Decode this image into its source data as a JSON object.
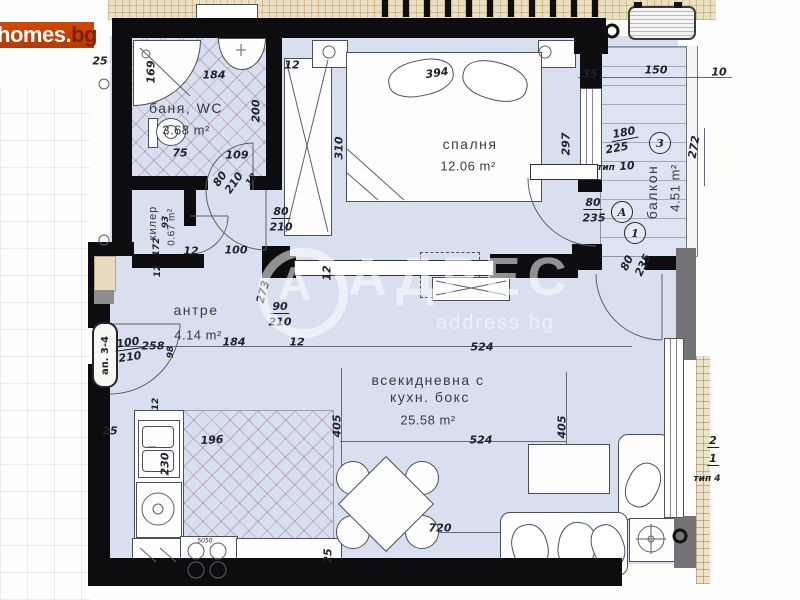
{
  "logo": {
    "homes": "homes",
    "dot": ".",
    "bg": "bg"
  },
  "watermark": {
    "brand": "АДРЕС",
    "domain": "address.bg",
    "monogram": "А"
  },
  "entrance_label": "ап. 3-4",
  "rooms_summary": [
    {
      "name": "баня, WC",
      "area_m2": "3.68 m²"
    },
    {
      "name": "килер",
      "area_m2": "0.67 m²"
    },
    {
      "name": "спалня",
      "area_m2": "12.06 m²"
    },
    {
      "name": "антре",
      "area_m2": "4.14 m²"
    },
    {
      "name": "всекидневна с кухн. бокс",
      "area_m2": "25.58 m²"
    },
    {
      "name": "балкон",
      "area_m2": "4.51 m²"
    }
  ],
  "room_labels": [
    {
      "t": "баня, WC",
      "x": 186,
      "y": 108,
      "r": 0,
      "c": "room"
    },
    {
      "t": "3.68 m²",
      "x": 186,
      "y": 130,
      "r": 0,
      "c": "area"
    },
    {
      "t": "килер",
      "x": 153,
      "y": 223,
      "r": -90,
      "c": "room sm"
    },
    {
      "t": "0.67 m²",
      "x": 172,
      "y": 227,
      "r": -90,
      "c": "area sm"
    },
    {
      "t": "спалня",
      "x": 470,
      "y": 144,
      "r": 0,
      "c": "room"
    },
    {
      "t": "12.06 m²",
      "x": 468,
      "y": 166,
      "r": 0,
      "c": "area"
    },
    {
      "t": "антре",
      "x": 196,
      "y": 310,
      "r": 0,
      "c": "room"
    },
    {
      "t": "4.14 m²",
      "x": 198,
      "y": 335,
      "r": 0,
      "c": "area"
    },
    {
      "t": "всекидневна с",
      "x": 428,
      "y": 380,
      "r": 0,
      "c": "room"
    },
    {
      "t": "кухн. бокс",
      "x": 430,
      "y": 397,
      "r": 0,
      "c": "room"
    },
    {
      "t": "25.58 m²",
      "x": 428,
      "y": 420,
      "r": 0,
      "c": "area"
    },
    {
      "t": "балкон",
      "x": 652,
      "y": 192,
      "r": -90,
      "c": "room"
    },
    {
      "t": "4.51 m²",
      "x": 675,
      "y": 188,
      "r": -90,
      "c": "area"
    }
  ],
  "dimensions": [
    {
      "t": "25",
      "x": 100,
      "y": 61,
      "r": 0
    },
    {
      "t": "169",
      "x": 151,
      "y": 72,
      "r": -90
    },
    {
      "t": "184",
      "x": 214,
      "y": 75,
      "r": 0
    },
    {
      "t": "12",
      "x": 292,
      "y": 65,
      "r": 0
    },
    {
      "t": "394",
      "x": 437,
      "y": 73,
      "r": -8
    },
    {
      "t": "35",
      "x": 590,
      "y": 74,
      "r": 0
    },
    {
      "t": "150",
      "x": 656,
      "y": 70,
      "r": 0
    },
    {
      "t": "10",
      "x": 719,
      "y": 72,
      "r": 0
    },
    {
      "t": "200",
      "x": 256,
      "y": 111,
      "r": -90
    },
    {
      "t": "75",
      "x": 180,
      "y": 153,
      "r": 0
    },
    {
      "t": "109",
      "x": 237,
      "y": 155,
      "r": 0
    },
    {
      "t": "80",
      "x": 220,
      "y": 179,
      "r": -55
    },
    {
      "t": "210",
      "x": 234,
      "y": 183,
      "r": -55
    },
    {
      "t": "12",
      "x": 252,
      "y": 180,
      "r": -55,
      "c": "tiny"
    },
    {
      "t": "93",
      "x": 166,
      "y": 222,
      "r": -90,
      "c": "tiny"
    },
    {
      "t": "172",
      "x": 157,
      "y": 247,
      "r": -90,
      "c": "tiny"
    },
    {
      "t": "12",
      "x": 158,
      "y": 271,
      "r": -90,
      "c": "tiny"
    },
    {
      "t": "100",
      "x": 236,
      "y": 250,
      "r": 0
    },
    {
      "t": "12",
      "x": 191,
      "y": 251,
      "r": 0
    },
    {
      "t": "80",
      "x": 281,
      "y": 212,
      "r": 0,
      "c": "frac"
    },
    {
      "t": "210",
      "x": 281,
      "y": 227,
      "r": 0
    },
    {
      "t": "310",
      "x": 339,
      "y": 148,
      "r": -90
    },
    {
      "t": "297",
      "x": 566,
      "y": 144,
      "r": -90
    },
    {
      "t": "180",
      "x": 624,
      "y": 133,
      "r": -10,
      "c": "frac"
    },
    {
      "t": "225",
      "x": 617,
      "y": 148,
      "r": -10
    },
    {
      "t": "тип",
      "x": 606,
      "y": 168,
      "r": 0,
      "c": "tiny"
    },
    {
      "t": "10",
      "x": 627,
      "y": 166,
      "r": -5
    },
    {
      "t": "272",
      "x": 694,
      "y": 147,
      "r": -80
    },
    {
      "t": "80",
      "x": 593,
      "y": 203,
      "r": 0,
      "c": "frac"
    },
    {
      "t": "235",
      "x": 594,
      "y": 218,
      "r": 0
    },
    {
      "t": "80",
      "x": 627,
      "y": 263,
      "r": -65
    },
    {
      "t": "235",
      "x": 643,
      "y": 265,
      "r": -65
    },
    {
      "t": "273",
      "x": 263,
      "y": 292,
      "r": -75
    },
    {
      "t": "90",
      "x": 280,
      "y": 307,
      "r": 0,
      "c": "frac"
    },
    {
      "t": "210",
      "x": 280,
      "y": 322,
      "r": 0
    },
    {
      "t": "12",
      "x": 327,
      "y": 273,
      "r": -90
    },
    {
      "t": "184",
      "x": 234,
      "y": 342,
      "r": 0
    },
    {
      "t": "12",
      "x": 297,
      "y": 342,
      "r": 0
    },
    {
      "t": "100",
      "x": 128,
      "y": 343,
      "r": -8,
      "c": "frac"
    },
    {
      "t": "210",
      "x": 130,
      "y": 357,
      "r": -8
    },
    {
      "t": "258",
      "x": 153,
      "y": 346,
      "r": 0
    },
    {
      "t": "98",
      "x": 171,
      "y": 352,
      "r": -90,
      "c": "tiny"
    },
    {
      "t": "524",
      "x": 482,
      "y": 347,
      "r": 0
    },
    {
      "t": "405",
      "x": 337,
      "y": 426,
      "r": -90
    },
    {
      "t": "405",
      "x": 562,
      "y": 427,
      "r": -90
    },
    {
      "t": "196",
      "x": 212,
      "y": 440,
      "r": -3
    },
    {
      "t": "12",
      "x": 156,
      "y": 404,
      "r": -90,
      "c": "tiny"
    },
    {
      "t": "230",
      "x": 165,
      "y": 464,
      "r": -90
    },
    {
      "t": "25",
      "x": 110,
      "y": 431,
      "r": 0
    },
    {
      "t": "524",
      "x": 481,
      "y": 440,
      "r": 0
    },
    {
      "t": "720",
      "x": 440,
      "y": 528,
      "r": 0
    },
    {
      "t": "25",
      "x": 328,
      "y": 556,
      "r": -90
    },
    {
      "t": "5050",
      "x": 205,
      "y": 541,
      "r": 0,
      "c": "micro"
    },
    {
      "t": "2",
      "x": 713,
      "y": 441,
      "r": 0,
      "c": "frac"
    },
    {
      "t": "1",
      "x": 713,
      "y": 459,
      "r": 0,
      "c": "frac"
    },
    {
      "t": "тип 4",
      "x": 707,
      "y": 479,
      "r": 0,
      "c": "tiny"
    }
  ],
  "markers": [
    {
      "t": "3",
      "x": 660,
      "y": 143
    },
    {
      "t": "A",
      "x": 622,
      "y": 212
    },
    {
      "t": "1",
      "x": 635,
      "y": 233
    }
  ]
}
